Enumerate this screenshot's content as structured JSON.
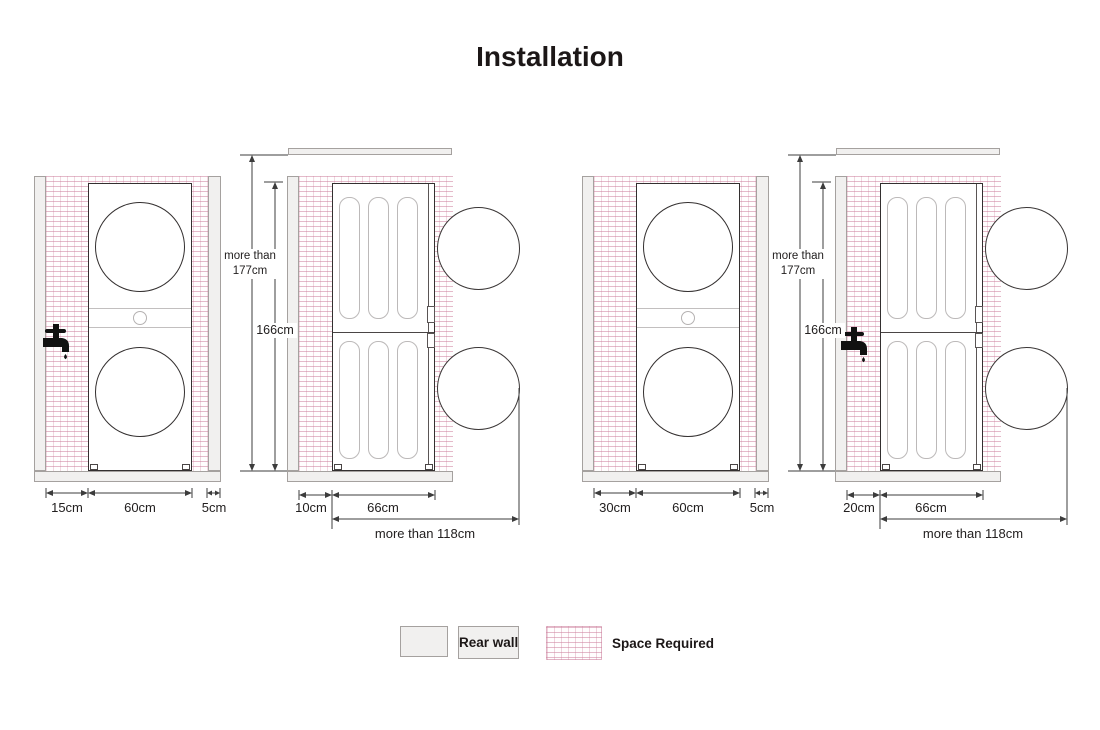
{
  "title": "Installation",
  "legend": {
    "rear_wall_label": "Rear wall",
    "space_required_label": "Space Required"
  },
  "diagrams": [
    {
      "id": "left",
      "front_view": {
        "left_gap": "15cm",
        "unit_width": "60cm",
        "right_gap": "5cm"
      },
      "side_view": {
        "rear_gap": "10cm",
        "unit_depth": "66cm",
        "door_clearance": "more than 118cm"
      },
      "heights": {
        "total_min_line1": "more than",
        "total_min_line2": "177cm",
        "unit_height": "166cm"
      },
      "faucet_location": "front-view-left-wall"
    },
    {
      "id": "right",
      "front_view": {
        "left_gap": "30cm",
        "unit_width": "60cm",
        "right_gap": "5cm"
      },
      "side_view": {
        "rear_gap": "20cm",
        "unit_depth": "66cm",
        "door_clearance": "more than 118cm"
      },
      "heights": {
        "total_min_line1": "more than",
        "total_min_line2": "177cm",
        "unit_height": "166cm"
      },
      "faucet_location": "side-view-rear-gap"
    }
  ],
  "icons": {
    "faucet": "faucet-icon"
  },
  "colors": {
    "title_text": "#1c1717",
    "wall_fill": "#f1f0ef",
    "wall_border": "#a5a19f",
    "space_grid_line": "#cd829e",
    "dimension_line": "#3c3c3c",
    "appliance_outline": "#332f2f"
  }
}
